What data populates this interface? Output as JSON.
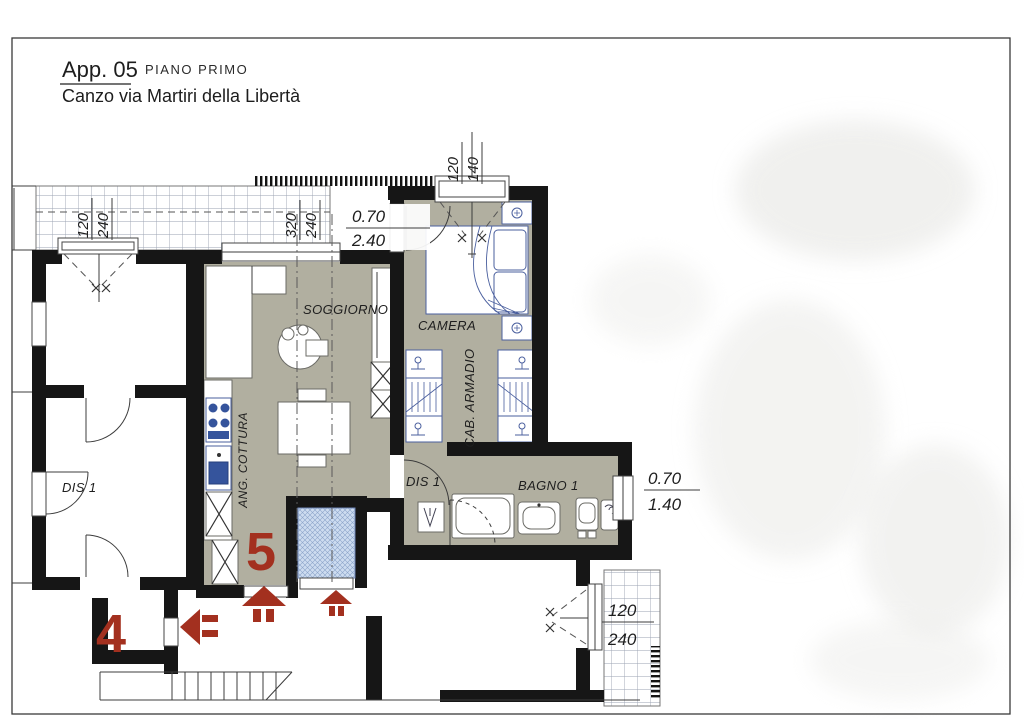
{
  "page": {
    "title": "App. 05",
    "floor_label": "PIANO PRIMO",
    "address": "Canzo via Martiri della Libertà"
  },
  "plan": {
    "rooms": {
      "living": "SOGGIORNO",
      "bedroom": "CAMERA",
      "wardrobe": "CAB. ARMADIO",
      "kitchen": "ANG. COTTURA",
      "bath": "BAGNO 1",
      "hall_apt5": "DIS 1",
      "hall_apt4": "DIS 1"
    },
    "units": {
      "current": "5",
      "adjacent": "4"
    },
    "dimensions": {
      "terrace_window": {
        "w": "120",
        "h": "240"
      },
      "living_window": {
        "w": "320",
        "h": "240"
      },
      "bedroom_door": {
        "w": "0.70",
        "h": "2.40"
      },
      "bedroom_window": {
        "w": "120",
        "h": "140"
      },
      "bath_window": {
        "w": "0.70",
        "h": "1.40"
      },
      "balcony_window": {
        "w": "120",
        "h": "240"
      }
    },
    "colors": {
      "floor_fill": "#b1afa0",
      "wall": "#161616",
      "fixture_stroke": "#4a5f9e",
      "annotation_red": "#a3301f"
    }
  }
}
